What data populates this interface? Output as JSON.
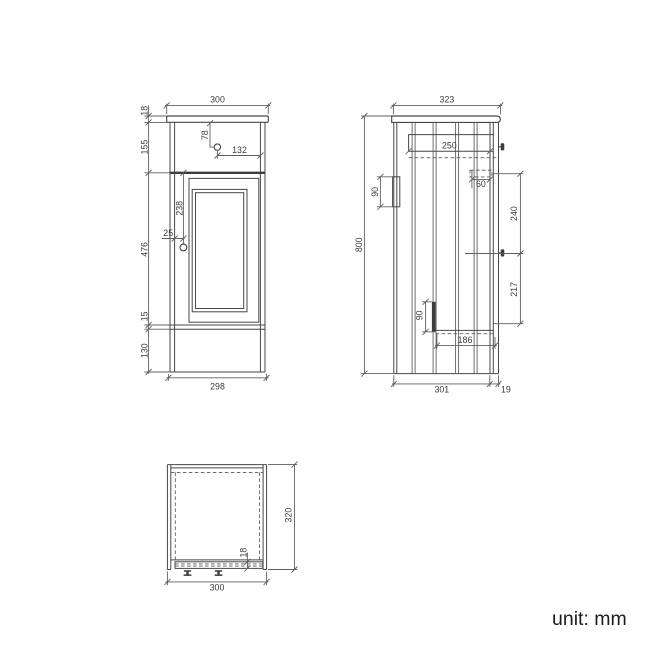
{
  "note": {
    "unit_label": "unit: mm"
  },
  "front_view": {
    "top_width": "300",
    "countertop_thickness": "18",
    "upper_section_height": "155",
    "knob_from_top": "78",
    "knob_from_right": "132",
    "door_knob_drop": "238",
    "door_knob_inset": "25",
    "door_section_height": "476",
    "bottom_rail_height": "15",
    "plinth_height": "130",
    "base_width": "298"
  },
  "side_view": {
    "top_depth": "323",
    "overall_height": "800",
    "internal_width": "250",
    "bracket_height": "90",
    "runner_length": "60",
    "upper_span": "240",
    "lower_span": "217",
    "hinge_plate_height": "90",
    "shelf_depth": "186",
    "carcass_depth": "301",
    "door_thickness": "19"
  },
  "plan_view": {
    "overall_depth": "320",
    "overall_width": "300",
    "door_thickness": "18"
  }
}
